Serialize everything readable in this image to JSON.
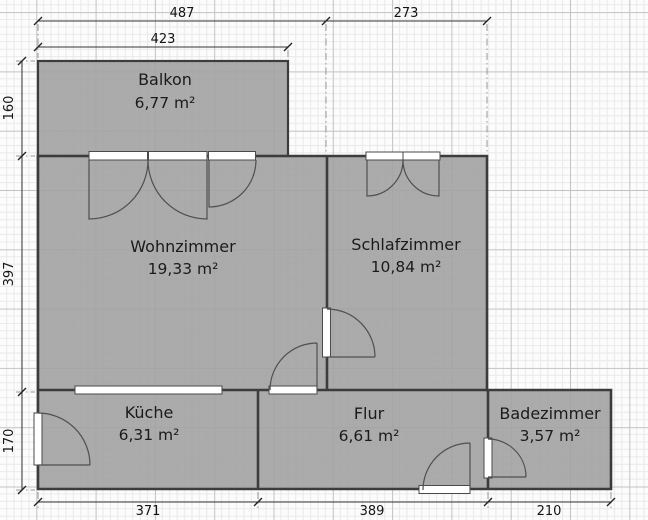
{
  "plan": {
    "title": "floor-plan",
    "rooms": [
      {
        "id": "balkon",
        "name": "Balkon",
        "area": "6,77 m²"
      },
      {
        "id": "wohnzimmer",
        "name": "Wohnzimmer",
        "area": "19,33 m²"
      },
      {
        "id": "schlafzimmer",
        "name": "Schlafzimmer",
        "area": "10,84 m²"
      },
      {
        "id": "kueche",
        "name": "Küche",
        "area": "6,31 m²"
      },
      {
        "id": "flur",
        "name": "Flur",
        "area": "6,61 m²"
      },
      {
        "id": "badezimmer",
        "name": "Badezimmer",
        "area": "3,57 m²"
      }
    ],
    "dimensions": {
      "top_total": "487",
      "top_right": "273",
      "top_balcony": "423",
      "left_balcony": "160",
      "left_main": "397",
      "left_bottom": "170",
      "bottom_left": "371",
      "bottom_middle": "389",
      "bottom_right": "210"
    },
    "colors": {
      "background": "#fcfcfc",
      "grid_minor": "#e9e9e9",
      "grid_major": "#c3c3c3",
      "room_fill": "#a2a2a2",
      "wall": "#3c3c3c",
      "opening_fill": "#ffffff",
      "opening_stroke": "#4a4a4a",
      "dimension_line": "#333333",
      "extension_line": "#999999"
    }
  }
}
